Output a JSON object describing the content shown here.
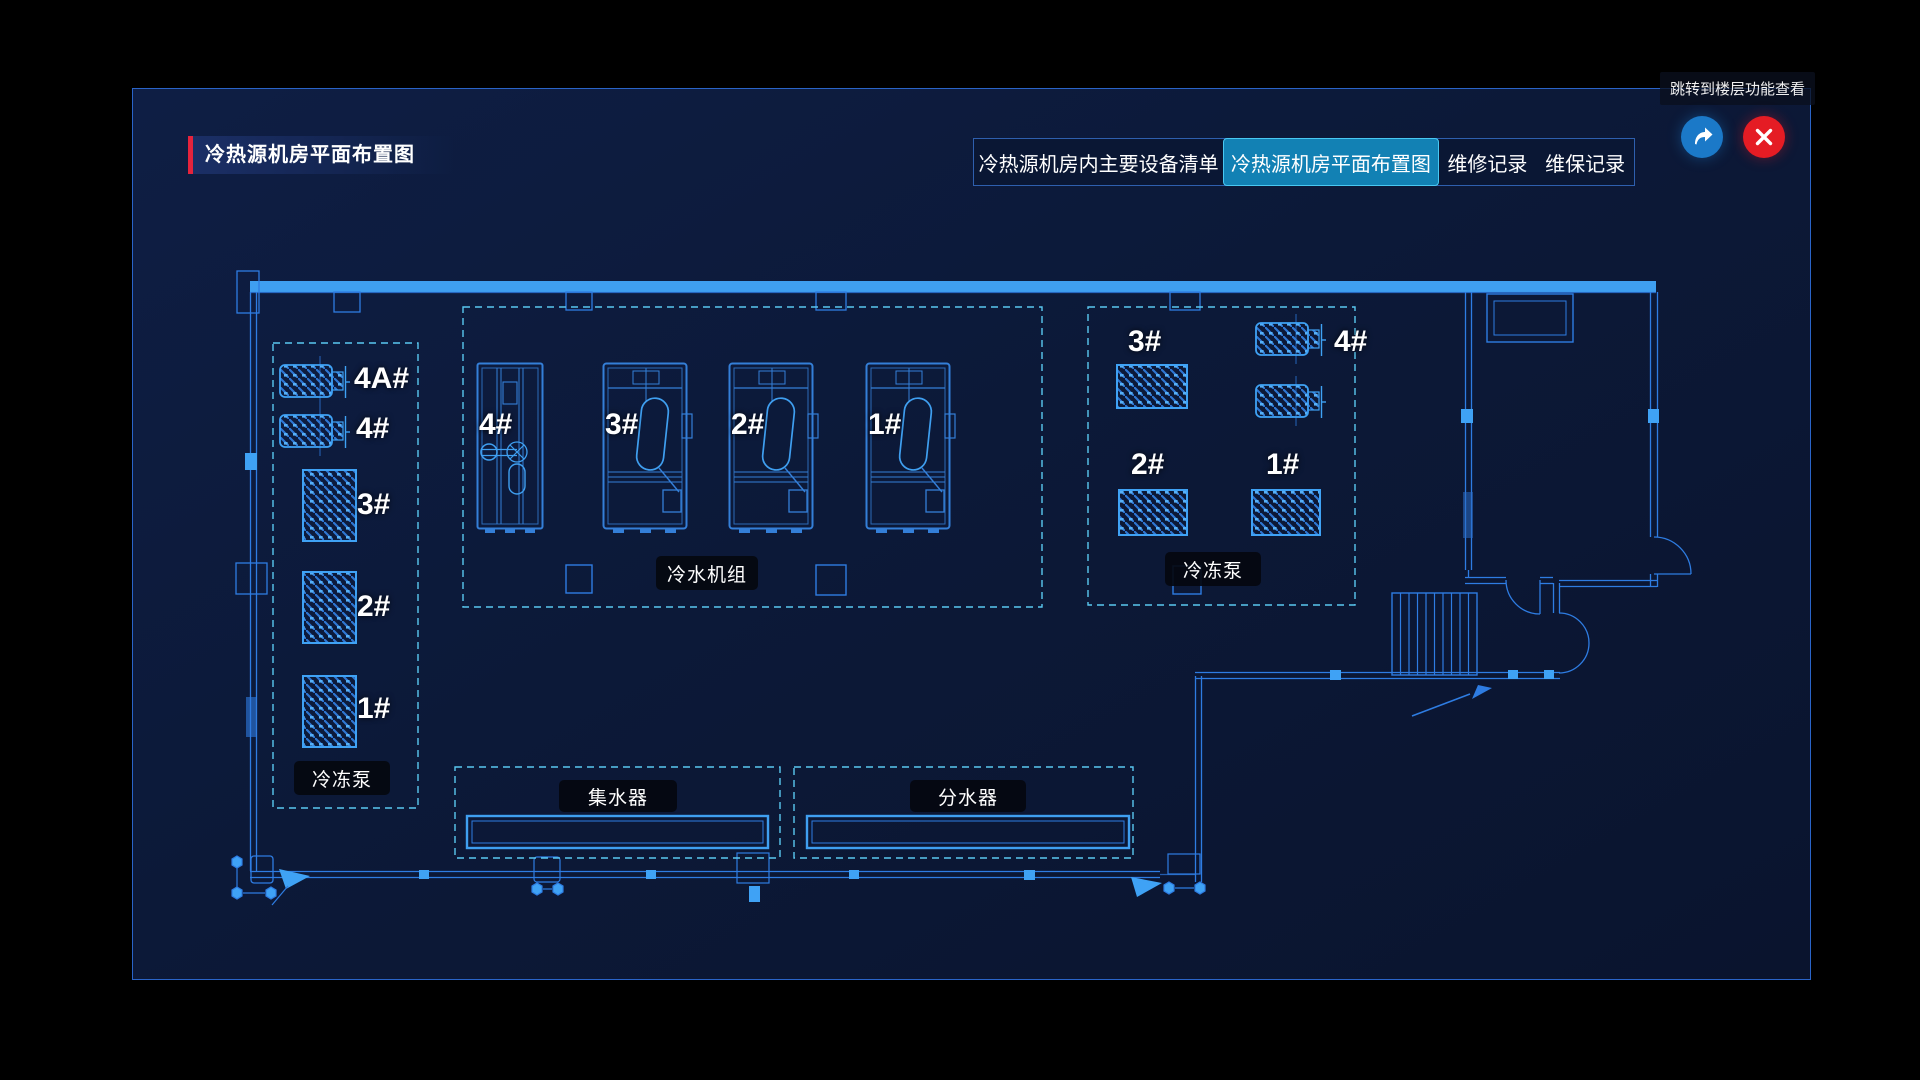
{
  "panel": {
    "title": "冷热源机房平面布置图"
  },
  "tabs": [
    {
      "label": "冷热源机房内主要设备清单",
      "active": false
    },
    {
      "label": "冷热源机房平面布置图",
      "active": true
    },
    {
      "label": "维修记录",
      "active": false
    },
    {
      "label": "维保记录",
      "active": false
    }
  ],
  "tooltip": "跳转到楼层功能查看",
  "icons": {
    "share": "jump-share-arrow-icon",
    "close": "close-x-icon"
  },
  "plan": {
    "zones": {
      "left_pump_area": {
        "label": "冷冻泵",
        "units": [
          "4A#",
          "4#",
          "3#",
          "2#",
          "1#"
        ]
      },
      "chiller_area": {
        "label": "冷水机组",
        "units": [
          "4#",
          "3#",
          "2#",
          "1#"
        ]
      },
      "right_pump_area": {
        "label": "冷冻泵",
        "units": [
          "3#",
          "4#",
          "2#",
          "1#"
        ]
      },
      "collector": {
        "label": "集水器"
      },
      "distributor": {
        "label": "分水器"
      }
    }
  },
  "colors": {
    "accent_red": "#e5233c",
    "active_tab_blue": "#1281b4",
    "line_blue": "#2e7ce2",
    "bright_blue": "#3fa2f5",
    "dash_cyan": "#5ac8f0",
    "share_blue": "#1b79c8",
    "close_red": "#e51c24"
  }
}
